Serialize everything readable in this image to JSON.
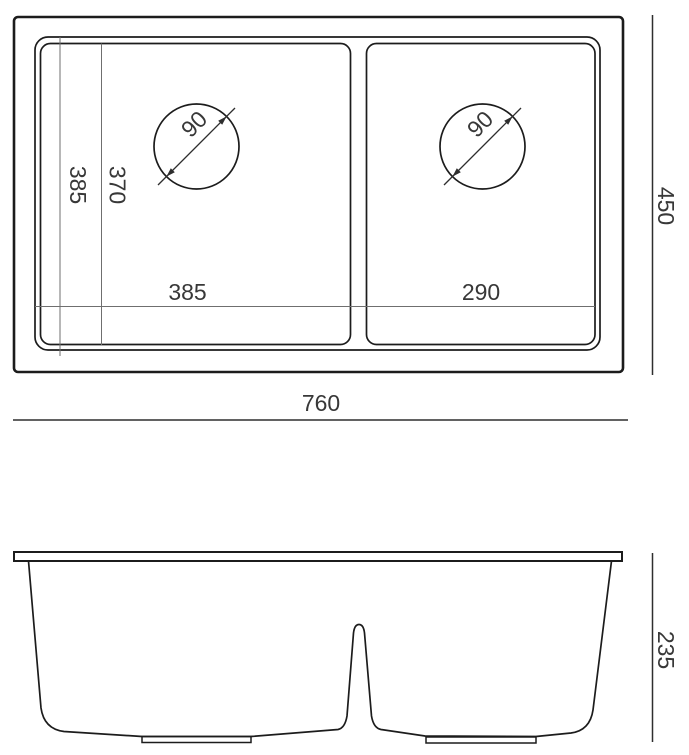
{
  "drawing": {
    "kind": "technical dimension drawing, double-bowl undermount sink, top view and front section view"
  },
  "colors": {
    "background": "#ffffff",
    "outline": "#1c1c1c",
    "dimension_line": "#2e2e2e",
    "inner_dimension_line": "#6f6f6f",
    "text": "#383838"
  },
  "top_view": {
    "labels": {
      "left_drain_diameter": "90",
      "right_drain_diameter": "90",
      "left_bowl_length_outer": "385",
      "left_bowl_length_inner": "370",
      "left_bowl_width": "385",
      "right_bowl_width": "290",
      "overall_width": "760",
      "overall_depth": "450"
    }
  },
  "front_view": {
    "labels": {
      "overall_height": "235"
    }
  }
}
